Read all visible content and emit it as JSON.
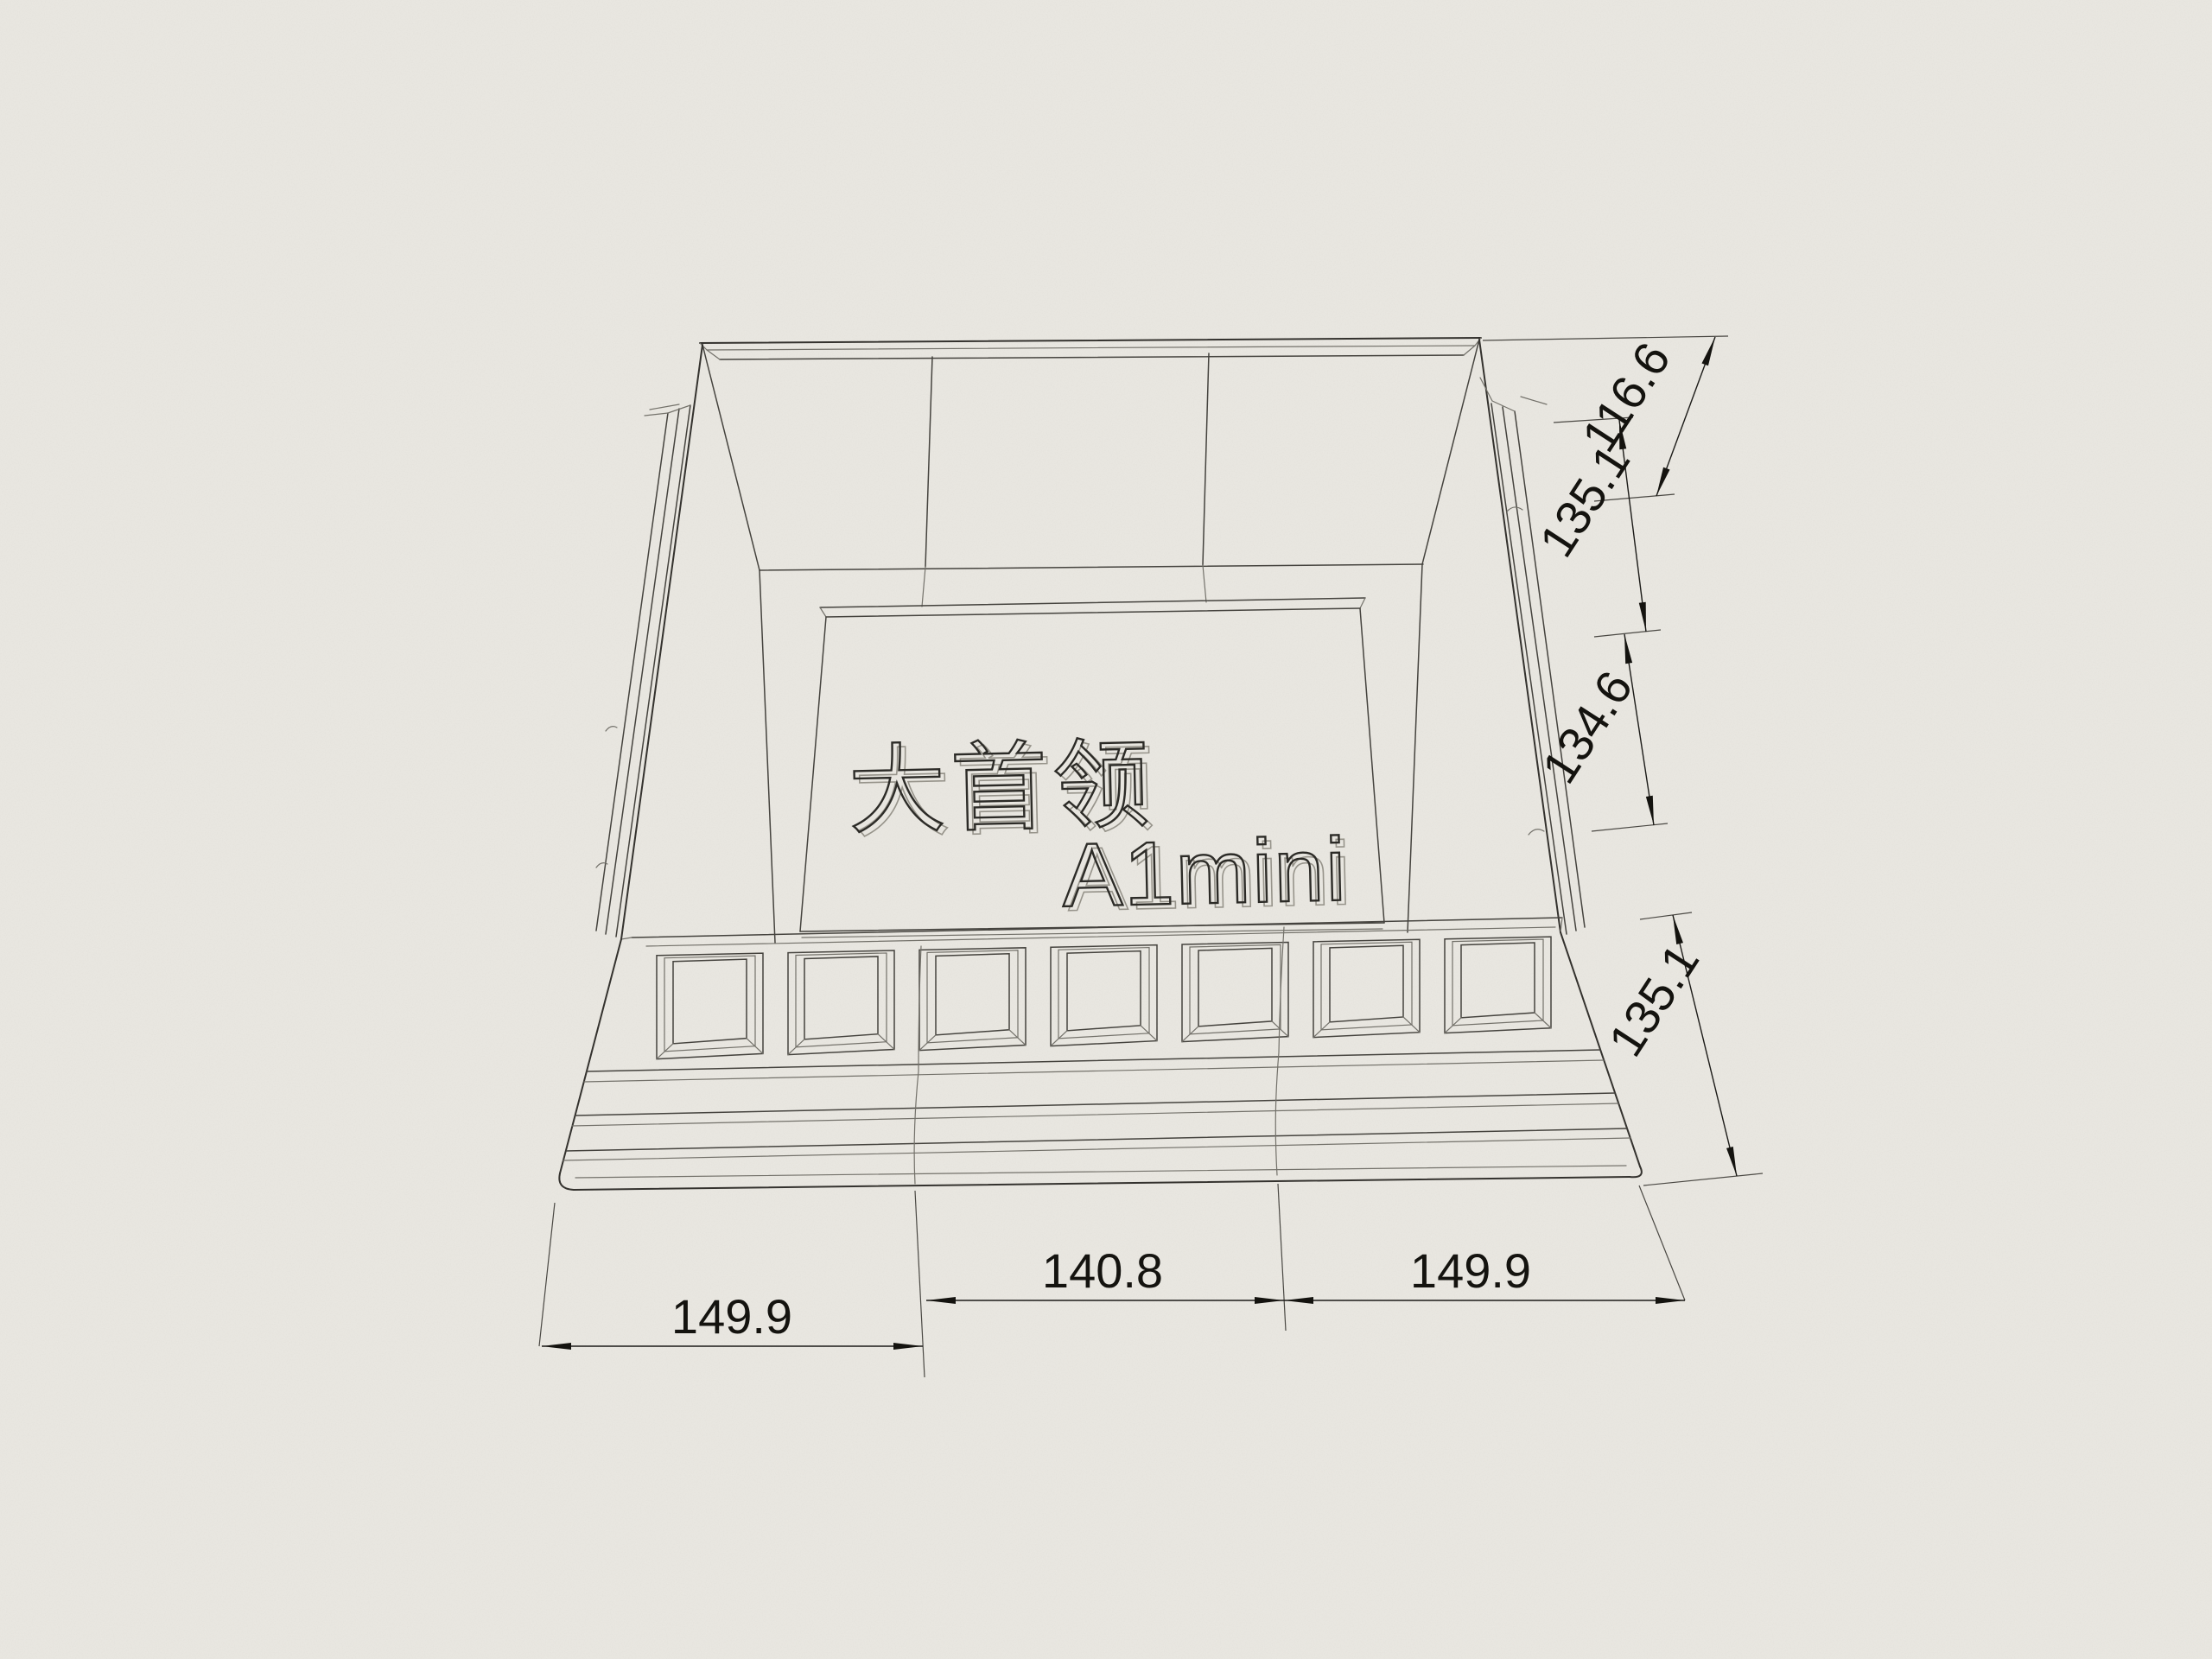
{
  "drawing": {
    "plate": {
      "title": "大首领",
      "subtitle": "A1mini"
    },
    "dimensions": {
      "right": [
        {
          "id": "dim-right-1",
          "value": "116.6"
        },
        {
          "id": "dim-right-2",
          "value": "135.1"
        },
        {
          "id": "dim-right-3",
          "value": "134.6"
        },
        {
          "id": "dim-right-4",
          "value": "135.1"
        }
      ],
      "bottom": [
        {
          "id": "dim-bottom-left",
          "value": "149.9"
        },
        {
          "id": "dim-bottom-middle",
          "value": "140.8"
        },
        {
          "id": "dim-bottom-right",
          "value": "149.9"
        }
      ]
    },
    "colors": {
      "paper": "#ebe9e3",
      "line": "#34322e",
      "dim_text": "#14130f"
    }
  }
}
